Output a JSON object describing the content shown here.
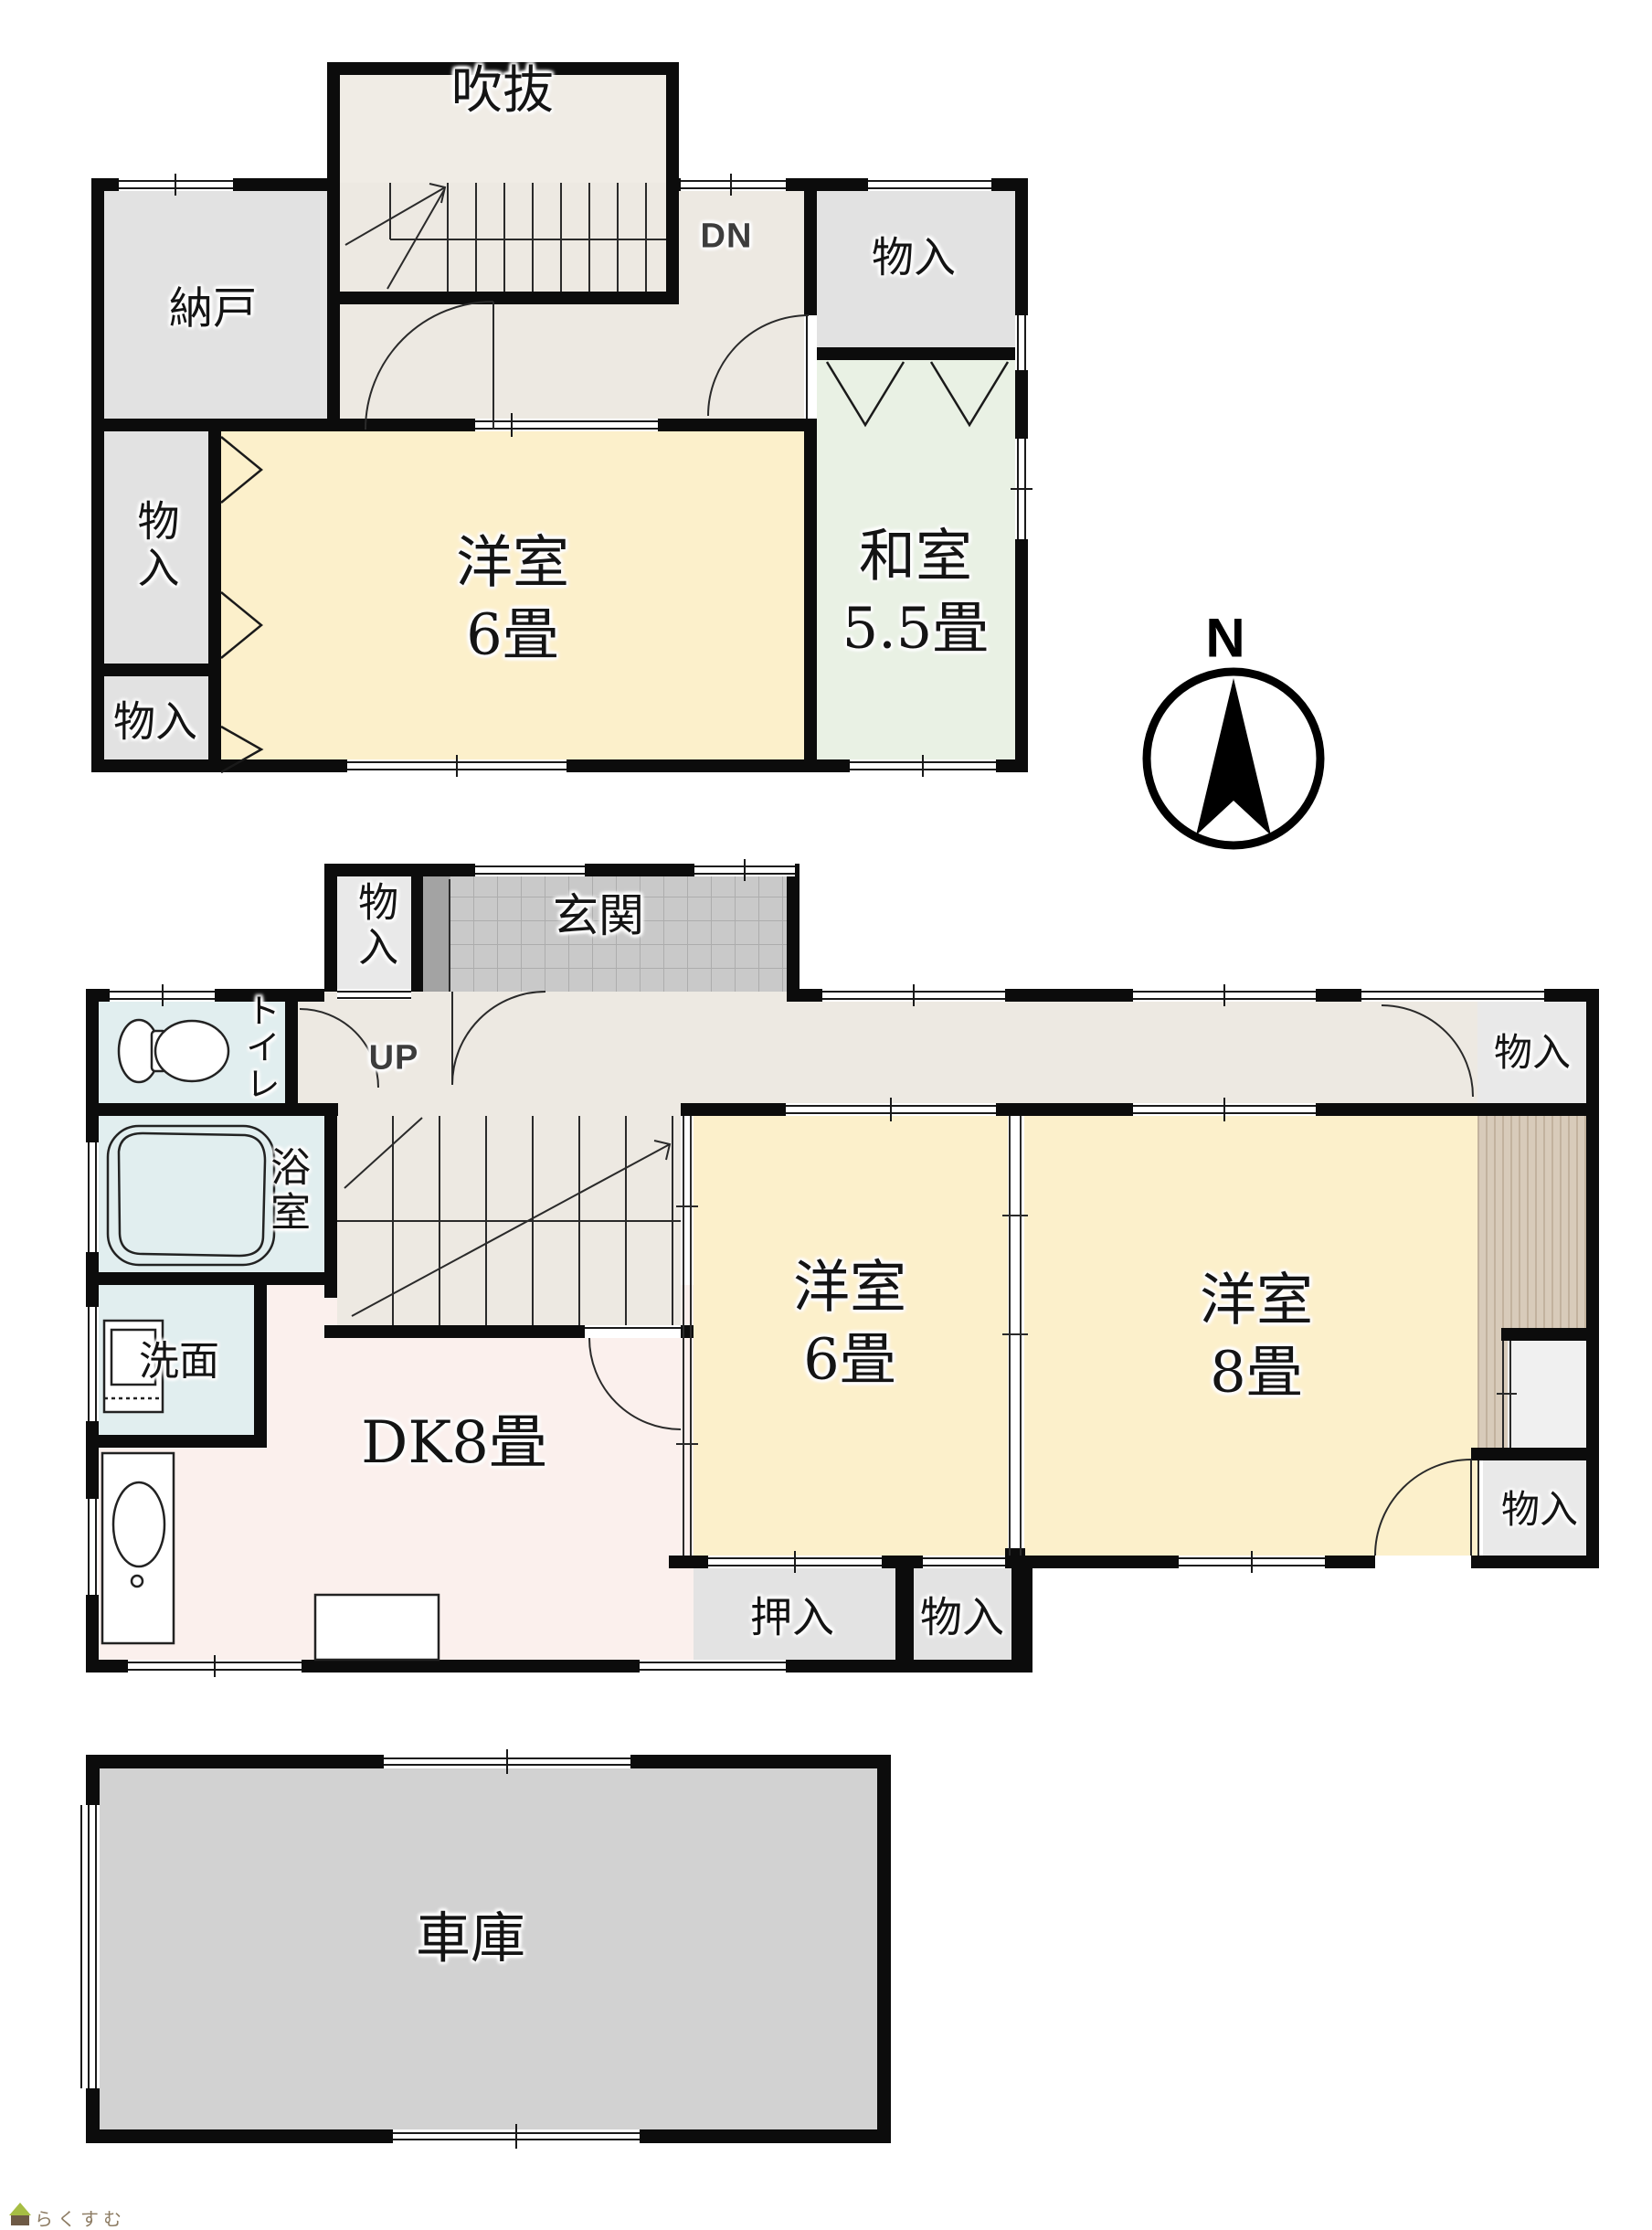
{
  "floor2": {
    "fukinuke": "吹抜",
    "dn": "DN",
    "nando": "納戸",
    "closet_mid": "物入",
    "closet_bottom": "物入",
    "closet_topright": "物入",
    "yoshitsu": {
      "name": "洋室",
      "size": "6畳"
    },
    "washitsu": {
      "name": "和室",
      "size": "5.5畳"
    }
  },
  "floor1": {
    "closet_entry": "物入",
    "genkan": "玄関",
    "toilet": "トイレ",
    "up": "UP",
    "bath": "浴室",
    "senmen": "洗面",
    "dk": "DK8畳",
    "yoshitsu6": {
      "name": "洋室",
      "size": "6畳"
    },
    "yoshitsu8": {
      "name": "洋室",
      "size": "8畳"
    },
    "oshiire": "押入",
    "closet_south": "物入",
    "closet_ne": "物入",
    "closet_se": "物入"
  },
  "garage": {
    "label": "車庫"
  },
  "compass": {
    "north": "N"
  },
  "watermark": {
    "brand": "らくすむ"
  },
  "palette": {
    "wall": "#0C0C0C",
    "western_room": "#FCF0CB",
    "japanese_room": "#E9F1E4",
    "hall": "#EDE9E2",
    "closet": "#E2E2E2",
    "wet_room": "#E1EEEF",
    "dk": "#FBF0ED",
    "entrance_tile": "#C9C9C9",
    "garage": "#D2D2D2",
    "wood_deck": "#D8CBBA"
  }
}
